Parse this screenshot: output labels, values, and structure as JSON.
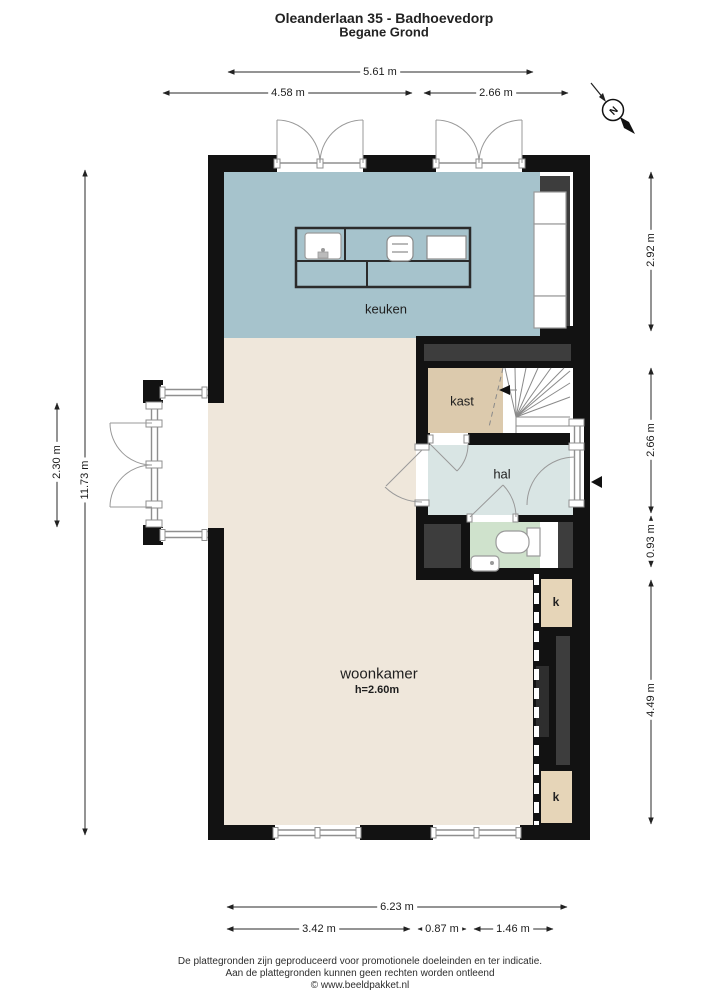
{
  "title": {
    "line1": "Oleanderlaan 35 - Badhoevedorp",
    "line2": "Begane Grond"
  },
  "compass": {
    "label": "N"
  },
  "rooms": {
    "keuken": "keuken",
    "kast": "kast",
    "hal": "hal",
    "woonkamer": "woonkamer",
    "woonkamer_height": "h=2.60m",
    "closet_top": "k",
    "closet_bottom": "k"
  },
  "dimensions": {
    "top": {
      "total": "5.61 m",
      "left": "4.58 m",
      "right": "2.66 m"
    },
    "bottom": {
      "total": "6.23 m",
      "seg1": "3.42 m",
      "seg2": "0.87 m",
      "seg3": "1.46 m"
    },
    "left": {
      "total": "11.73 m",
      "bay": "2.30 m"
    },
    "right": {
      "seg1": "2.92 m",
      "seg2": "2.66 m",
      "seg3": "0.93 m",
      "seg4": "4.49 m"
    }
  },
  "footer": {
    "line1": "De plattegronden zijn geproduceerd voor promotionele doeleinden en ter indicatie.",
    "line2": "Aan de plattegronden kunnen geen rechten worden ontleend",
    "line3": "© www.beeldpakket.nl"
  },
  "colors": {
    "wall": "#121212",
    "cabinet": "#3d3d3d",
    "cabinet_dark": "#2e2e2e",
    "kitchen": "#a6c3cc",
    "living": "#efe7db",
    "kast": "#dccaad",
    "hal": "#d9e5e4",
    "toilet": "#cfe2cc",
    "closet": "#e6d5b8",
    "window_line": "#8f8f8f",
    "door_line": "#999999",
    "dim": "#2a2a2a",
    "island_line": "#2b2b2b"
  }
}
